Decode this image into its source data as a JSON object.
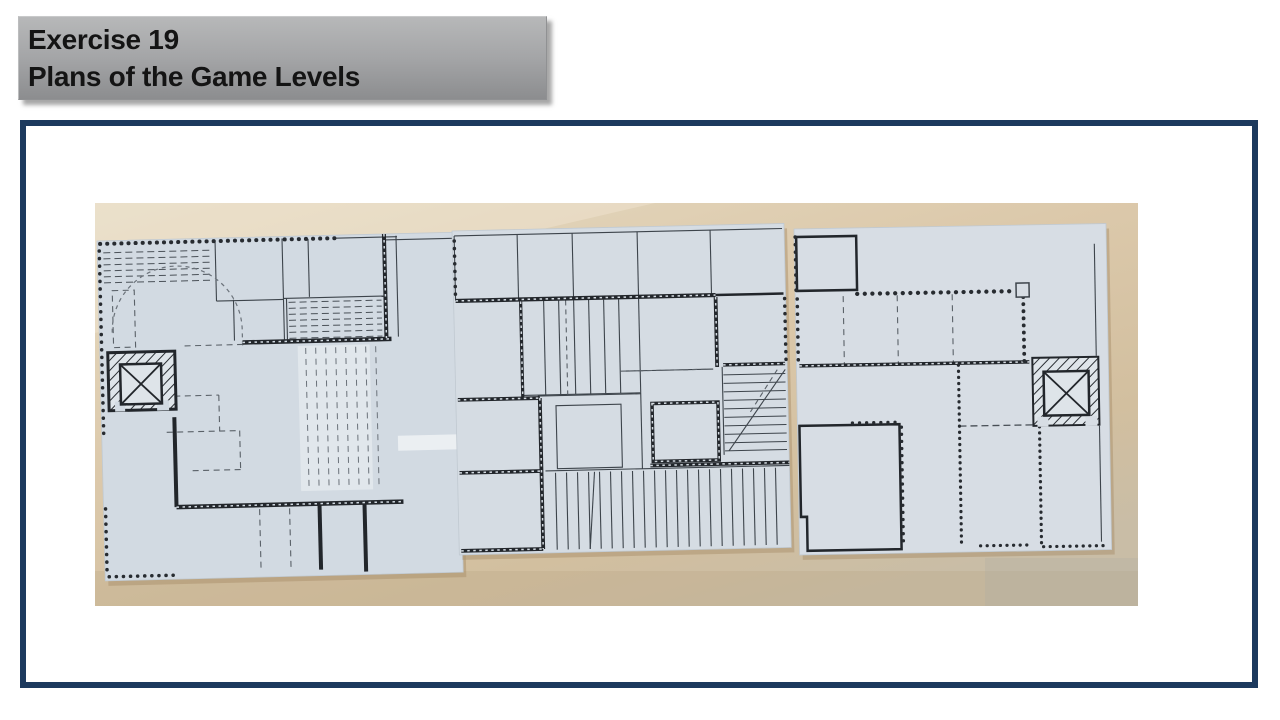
{
  "banner": {
    "line1": "Exercise 19",
    "line2": "Plans of the Game Levels"
  },
  "figure": {
    "type": "photograph",
    "description": "Three hand-drawn game level floor plans on light blue-grey paper sheets lying side by side on a wooden table",
    "sheet_count": 3,
    "sheets": [
      "left-level-plan",
      "middle-level-plan",
      "right-level-plan"
    ],
    "plan_features": [
      "hatched elevator shafts with X symbol",
      "dashed partition lines",
      "beaded/scalloped wall textures",
      "stair stripe blocks",
      "quarter-circle door swing arc"
    ]
  },
  "colors": {
    "banner_gradient_top": "#b7b8b9",
    "banner_gradient_bottom": "#8c8d8f",
    "banner_text": "#141414",
    "frame_border": "#1d3a5e",
    "slide_background": "#ffffff",
    "table_wood": "#d9c6a8",
    "paper": "#d5dce3",
    "ink": "#22262b"
  }
}
